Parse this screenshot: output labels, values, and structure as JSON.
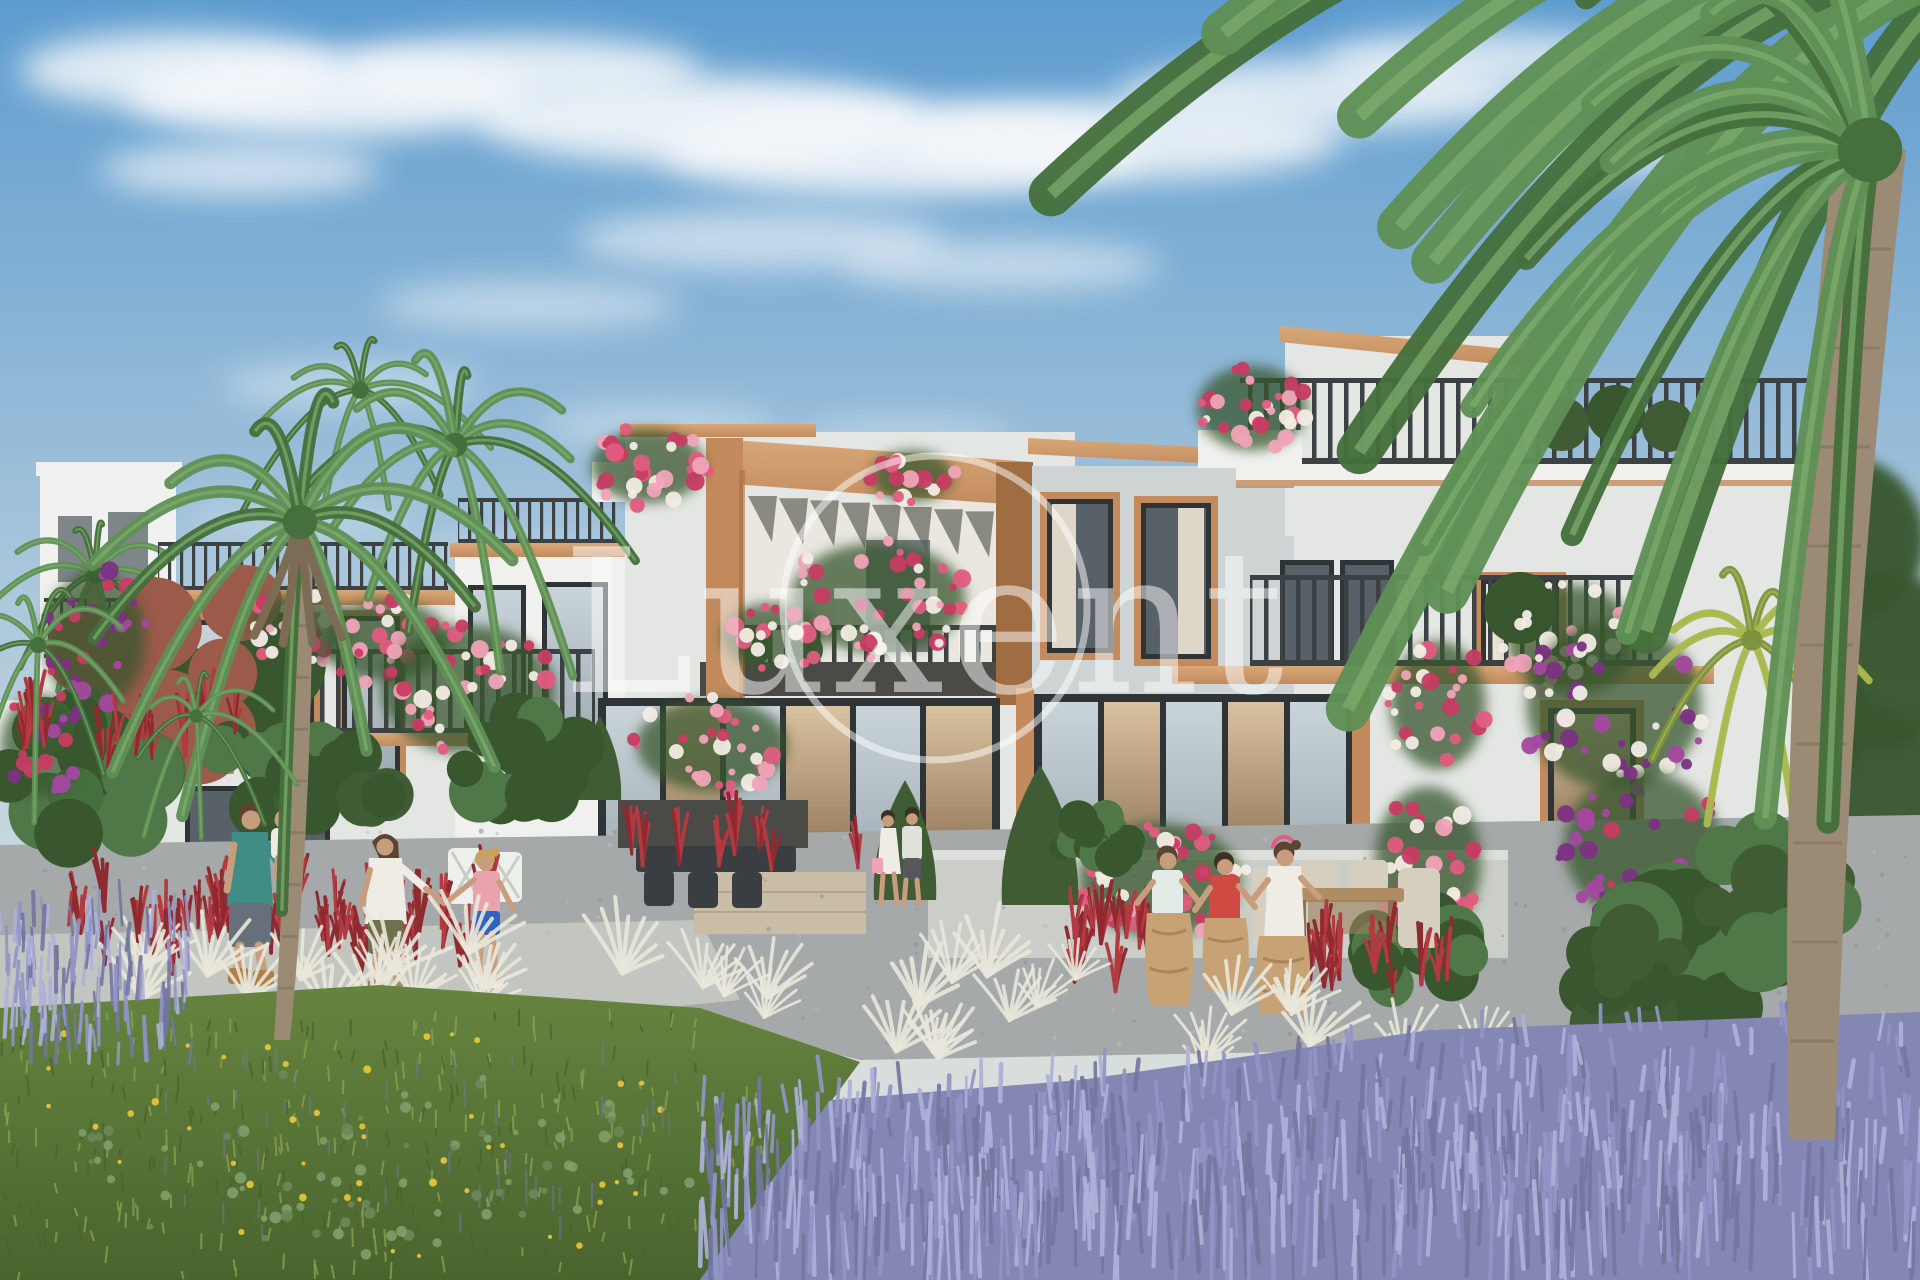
{
  "meta": {
    "type": "architectural-rendering",
    "subject": "Mediterranean townhouse community with palm trees, bougainvillea, lavender garden and families outdoors"
  },
  "watermark": {
    "text": "Luxent",
    "color": "#ffffff",
    "opacity": 0.5
  },
  "palette": {
    "sky_top": "#5e9ccf",
    "sky_mid": "#a9c6db",
    "sky_low": "#cfdbe0",
    "sky_horizon": "#e6e2d6",
    "cloud": "#f5f8fa",
    "wall": "#e3e6e3",
    "wall_shade": "#ced4d4",
    "wall_bright": "#f0f1ee",
    "parapet_shadow": "#b7bec0",
    "trim": "#c38b5d",
    "trim_dark": "#a06c41",
    "trim_light": "#d8a878",
    "railing": "#3c4144",
    "frame": "#2f3436",
    "glass": "#c9d4da",
    "glass_dark": "#596168",
    "interior": "#d9c2a0",
    "interior_dark": "#8a6f52",
    "curtain": "#ece4d4",
    "pink": "#e05c80",
    "pink_light": "#f0a3b8",
    "pink_deep": "#c73c63",
    "white_flower": "#f2ece4",
    "purple_flower": "#a448a0",
    "purple_deep": "#7c3184",
    "leaf": "#4f7747",
    "leaf_dark": "#39572f",
    "palm": "#5f9055",
    "palm_dark": "#456f3c",
    "palm_light": "#7fae6e",
    "palm_gold": "#aab84f",
    "palm_gold_dark": "#7e9340",
    "cypress": "#3f5c35",
    "maple_red": "#9c5a4a",
    "trunk": "#9b8a74",
    "trunk_dark": "#7c6b55",
    "grass": "#66843f",
    "grass_dark": "#4a642e",
    "meadow_light": "#8aa050",
    "lavender": "#9295c6",
    "lavender_light": "#aeb1d8",
    "lavender_dark": "#74779f",
    "red_grass": "#b23a40",
    "red_grass_dark": "#8e2a30",
    "white_grass": "#e9e7da",
    "yellow": "#e3c43c",
    "gravel": "#a5a9a9",
    "gravel_dark": "#8f9495",
    "path": "#c3c6c0",
    "slab": "#cbcec8",
    "deck": "#c9bda6",
    "sack": "#c6a275",
    "sack_dark": "#a9855c",
    "skin": "#c89d7e",
    "hair_brown": "#5b4430",
    "hair_dark": "#3c2f24",
    "hair_blonde": "#c9a05e",
    "teal_shirt": "#3f8d85",
    "gray_shorts": "#66707a",
    "white_cloth": "#efece6",
    "olive_shorts": "#716f4e",
    "pink_shirt": "#e9a3ad",
    "blue_shorts": "#2f63c0",
    "red_shirt": "#cf4a42",
    "boot": "#b07f44",
    "wood": "#b08c62",
    "chair_beige": "#d6cfc0",
    "furniture_white": "#eef0ec",
    "planter_dark": "#4a4a46",
    "stool_dark": "#3a3e42"
  },
  "scene": {
    "sky": "blue sky with wispy white clouds",
    "buildings": "white two- and three-storey townhouses with terracotta portal frame, dark metal balcony railings and roof terraces",
    "people": [
      {
        "id": "father-with-toddler",
        "desc": "man in teal t-shirt carrying a toddler"
      },
      {
        "id": "mother",
        "desc": "woman in white blouse and olive shorts"
      },
      {
        "id": "daughter",
        "desc": "girl in pink top and blue shorts"
      },
      {
        "id": "strolling-couple",
        "desc": "couple walking by the glass doors"
      },
      {
        "id": "sack-race-children",
        "desc": "three children racing in burlap sacks"
      }
    ],
    "vegetation": [
      "tall palm trees",
      "overhanging palm fronds",
      "pink bougainvillea",
      "purple bougainvillea",
      "lavender field",
      "red ornamental grasses",
      "white feather grasses",
      "lawn with yellow wildflowers",
      "cypress shrubs"
    ]
  }
}
